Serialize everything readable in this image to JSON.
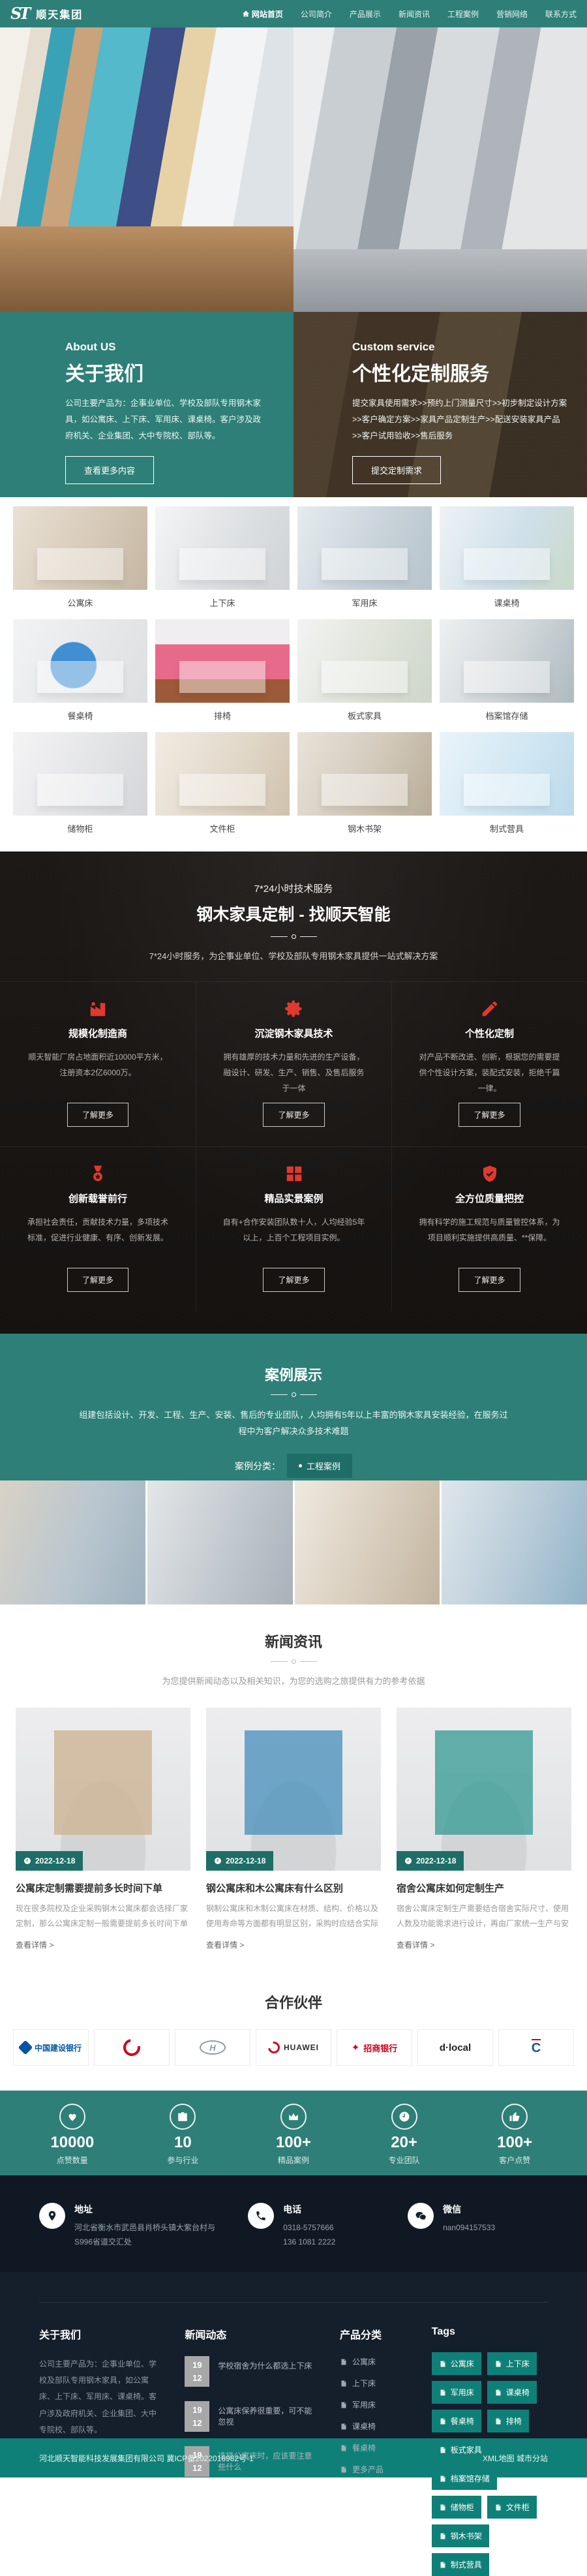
{
  "colors": {
    "teal": "#2E7F77",
    "teal_dark": "#1E6E67",
    "teal_bar": "#0F8077",
    "accent_red": "#E0392F",
    "contact_bg": "#101923",
    "footer_bg": "#151E2B"
  },
  "header": {
    "brand_mark": "ST",
    "brand_name": "顺天集团",
    "nav": [
      {
        "label": "网站首页"
      },
      {
        "label": "公司简介"
      },
      {
        "label": "产品展示"
      },
      {
        "label": "新闻资讯"
      },
      {
        "label": "工程案例"
      },
      {
        "label": "营销网络"
      },
      {
        "label": "联系方式"
      }
    ]
  },
  "about": {
    "eyebrow": "About US",
    "title": "关于我们",
    "body": "公司主要产品为：企事业单位、学校及部队专用钢木家具，如公寓床、上下床、军用床、课桌椅。客户涉及政府机关、企业集团、大中专院校、部队等。",
    "button": "查看更多内容"
  },
  "custom": {
    "eyebrow": "Custom service",
    "title": "个性化定制服务",
    "body": "提交家具使用需求>>预约上门测量尺寸>>初步制定设计方案>>客户确定方案>>家具产品定制生产>>配送安装家具产品>>客户试用验收>>售后服务",
    "button": "提交定制需求"
  },
  "products": {
    "items": [
      "公寓床",
      "上下床",
      "军用床",
      "课桌椅",
      "餐桌椅",
      "排椅",
      "板式家具",
      "档案馆存储",
      "储物柜",
      "文件柜",
      "钢木书架",
      "制式营具"
    ]
  },
  "tech": {
    "eyebrow": "7*24小时技术服务",
    "title": "钢木家具定制 - 找顺天智能",
    "subtitle": "7*24小时服务，为企事业单位、学校及部队专用钢木家具提供一站式解决方案",
    "cards": [
      {
        "icon": "factory-icon",
        "title": "规模化制造商",
        "body": "顺天智能厂房占地面积近10000平方米，注册资本2亿6000万。",
        "button": "了解更多"
      },
      {
        "icon": "gear-icon",
        "title": "沉淀钢木家具技术",
        "body": "拥有雄厚的技术力量和先进的生产设备，融设计、研发、生产、销售、及售后服务于一体",
        "button": "了解更多"
      },
      {
        "icon": "pencil-icon",
        "title": "个性化定制",
        "body": "对产品不断改进、创新，根据您的需要提供个性设计方案，装配式安装，拒绝千篇一律。",
        "button": "了解更多"
      },
      {
        "icon": "medal-icon",
        "title": "创新载誉前行",
        "body": "承担社会责任，贡献技术力量，多项技术标准，促进行业健康、有序、创新发展。",
        "button": "了解更多"
      },
      {
        "icon": "grid-icon",
        "title": "精品实景案例",
        "body": "自有+合作安装团队数十人，人均经验5年以上，上百个工程项目实例。",
        "button": "了解更多"
      },
      {
        "icon": "shield-icon",
        "title": "全方位质量把控",
        "body": "拥有科学的施工规范与质量管控体系，为项目顺利实施提供高质量、**保障。",
        "button": "了解更多"
      }
    ]
  },
  "cases": {
    "title": "案例展示",
    "subtitle": "组建包括设计、开发、工程、生产、安装、售后的专业团队，人均拥有5年以上丰富的钢木家具安装经验，在服务过程中为客户解决众多技术难题",
    "filter_label": "案例分类：",
    "filter_button": "工程案例"
  },
  "news": {
    "title": "新闻资讯",
    "subtitle": "为您提供新闻动态以及相关知识，为您的选购之旅提供有力的参考依据",
    "cards": [
      {
        "date": "2022-12-18",
        "title": "公寓床定制需要提前多长时间下单",
        "body": "现在很多院校及企业采购钢木公寓床都会选择厂家定制，那么公寓床定制一般需要提前多长时间下单呢…",
        "link": "查看详情 >"
      },
      {
        "date": "2022-12-18",
        "title": "钢公寓床和木公寓床有什么区别",
        "body": "钢制公寓床和木制公寓床在材质、结构、价格以及使用寿命等方面都有明显区别，采购时应结合实际需求…",
        "link": "查看详情 >"
      },
      {
        "date": "2022-12-18",
        "title": "宿舍公寓床如何定制生产",
        "body": "宿舍公寓床定制生产需要结合宿舍实际尺寸、使用人数及功能需求进行设计，再由厂家统一生产与安装…",
        "link": "查看详情 >"
      }
    ]
  },
  "partners": {
    "title": "合作伙伴",
    "logos": [
      {
        "label": "中国建设银行"
      },
      {
        "label": ""
      },
      {
        "label": "H"
      },
      {
        "label": "HUAWEI"
      },
      {
        "label": "招商银行"
      },
      {
        "label": "d·local"
      },
      {
        "label": "C"
      }
    ]
  },
  "stats": {
    "items": [
      {
        "icon": "heart-icon",
        "value": "10000",
        "label": "点赞数量"
      },
      {
        "icon": "briefcase-icon",
        "value": "10",
        "label": "参与行业"
      },
      {
        "icon": "crown-icon",
        "value": "100+",
        "label": "精品案例"
      },
      {
        "icon": "clock-icon",
        "value": "20+",
        "label": "专业团队"
      },
      {
        "icon": "thumb-icon",
        "value": "100+",
        "label": "客户点赞"
      }
    ]
  },
  "contact": {
    "items": [
      {
        "icon": "location-pin-icon",
        "label": "地址",
        "lines": [
          "河北省衡水市武邑县肖桥头镇大紫台村与",
          "S996省道交汇处"
        ]
      },
      {
        "icon": "phone-icon",
        "label": "电话",
        "lines": [
          "0318-5757666",
          "136 1081 2222"
        ]
      },
      {
        "icon": "wechat-icon",
        "label": "微信",
        "lines": [
          "nan094157533",
          ""
        ]
      }
    ]
  },
  "footer": {
    "about": {
      "title": "关于我们",
      "body": "公司主要产品为：企事业单位、学校及部队专用钢木家具，如公寓床、上下床、军用床、课桌椅。客户涉及政府机关、企业集团、大中专院校、部队等。"
    },
    "news": {
      "title": "新闻动态",
      "items": [
        {
          "day": "19",
          "month": "12",
          "title": "学校宿舍为什么都选上下床"
        },
        {
          "day": "19",
          "month": "12",
          "title": "公寓床保养很重要，可不能忽视"
        },
        {
          "day": "19",
          "month": "12",
          "title": "选择公寓床时，应该要注意些什么"
        }
      ]
    },
    "categories": {
      "title": "产品分类",
      "items": [
        "公寓床",
        "上下床",
        "军用床",
        "课桌椅",
        "餐桌椅",
        "更多产品"
      ]
    },
    "tags": {
      "title": "Tags",
      "items": [
        "公寓床",
        "上下床",
        "军用床",
        "课桌椅",
        "餐桌椅",
        "排椅",
        "板式家具",
        "档案馆存储",
        "储物柜",
        "文件柜",
        "钢木书架",
        "制式营具"
      ]
    }
  },
  "bottom_bar": {
    "left": "河北顺天智能科技发展集团有限公司 冀ICP备2022016982号-1",
    "right": "XML地图 城市分站"
  }
}
